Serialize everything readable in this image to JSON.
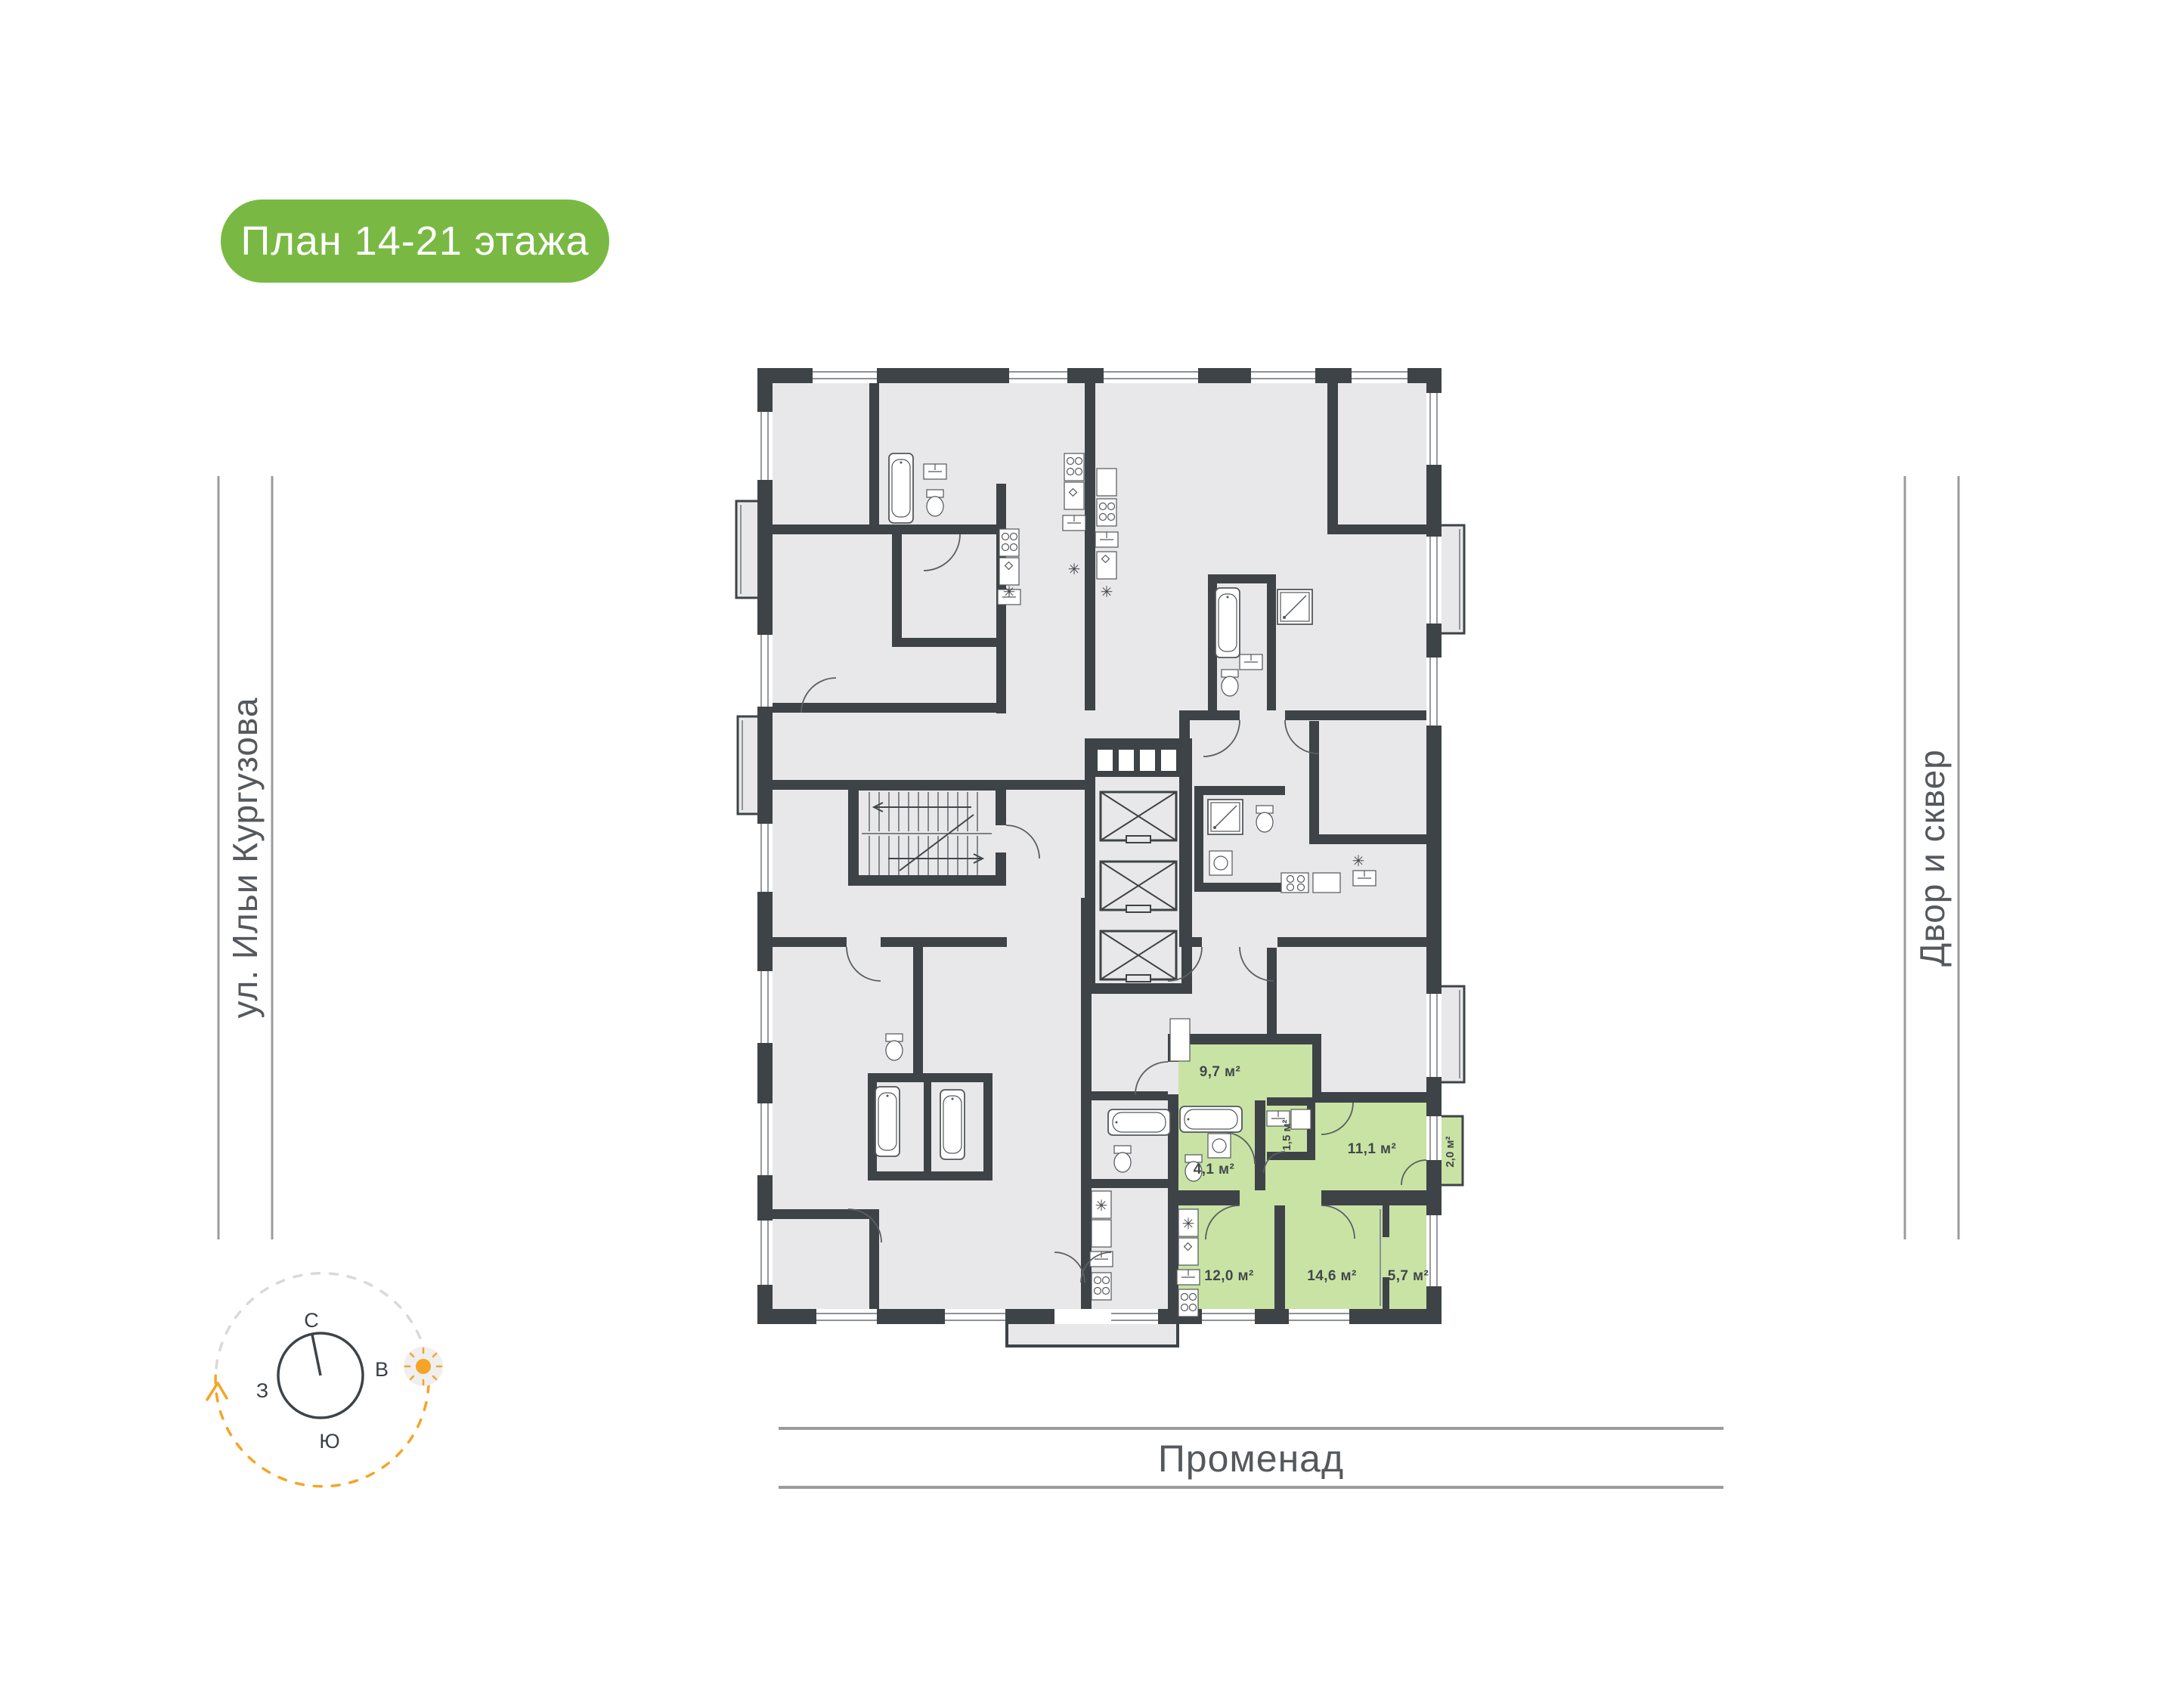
{
  "title_badge": {
    "label": "План 14-21 этажа"
  },
  "streets": {
    "left": "ул. Ильи Кургузова",
    "right": "Двор и сквер",
    "bottom": "Променад"
  },
  "compass": {
    "north": "С",
    "east": "В",
    "south": "Ю",
    "west": "З"
  },
  "floor_plan": {
    "highlighted_apartment": {
      "rooms": [
        {
          "name": "hall",
          "area": "9,7 м²"
        },
        {
          "name": "bathroom",
          "area": "4,1 м²"
        },
        {
          "name": "wc",
          "area": "1,5 м²"
        },
        {
          "name": "bedroom",
          "area": "11,1 м²"
        },
        {
          "name": "balcony",
          "area": "2,0 м²"
        },
        {
          "name": "kitchen",
          "area": "12,0 м²"
        },
        {
          "name": "living-room",
          "area": "14,6 м²"
        },
        {
          "name": "room",
          "area": "5,7 м²"
        }
      ]
    }
  },
  "symbols": {
    "conditioner": "✳"
  },
  "colors": {
    "badge_green": "#79B943",
    "apartment_green": "#C9E3A4",
    "wall_dark": "#3E4347",
    "floor_gray": "#E8E8EA",
    "accent_orange": "#F5A427",
    "street_line_gray": "#9B9B9B",
    "text_dark": "#42474C"
  }
}
